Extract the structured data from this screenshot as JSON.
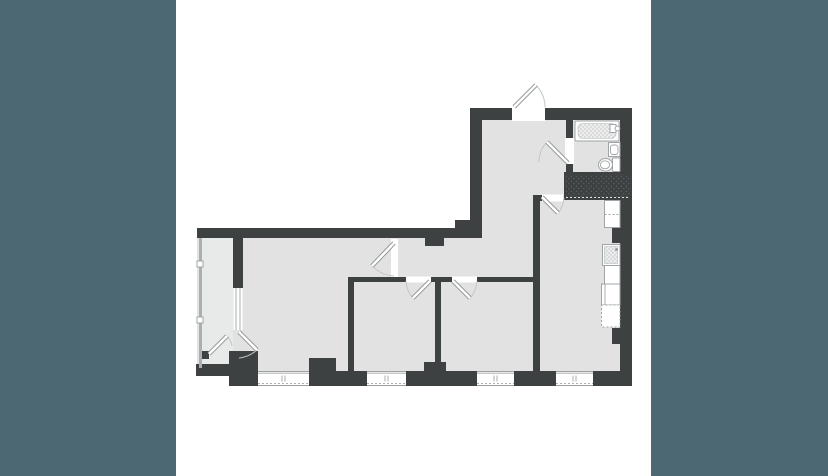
{
  "window": {
    "width": 828,
    "height": 476
  },
  "palette": {
    "backdrop": "#4C6872",
    "panel": "#FFFFFF",
    "wall": "#3E4142",
    "floor": "#E2E2E2",
    "floor_balcony": "#E8E9E9",
    "fixture_stroke": "#9FA4A6",
    "frame_stroke": "#8A9093",
    "arc_stroke": "#C3C7C8",
    "glazing": "#A9B0B2",
    "stipple": "#BDC1C2",
    "shaft_dot": "#62686A"
  },
  "floorplan": {
    "kind": "apartment-floor-plan",
    "shape": "L-shaped",
    "areas": [
      "entrance-hall",
      "bathroom",
      "duct-shaft",
      "kitchen-living-room",
      "corridor",
      "bedroom-1",
      "bedroom-2",
      "living-room",
      "balcony"
    ],
    "fixtures": [
      "bathtub",
      "washbasin",
      "toilet",
      "kitchen-counter",
      "kitchen-sink",
      "stove",
      "counter-appliance"
    ],
    "openings": {
      "entrance_door": 1,
      "interior_doors": 5,
      "balcony_door_leaves": 2,
      "balcony_window": 1,
      "facade_windows": 4
    }
  }
}
